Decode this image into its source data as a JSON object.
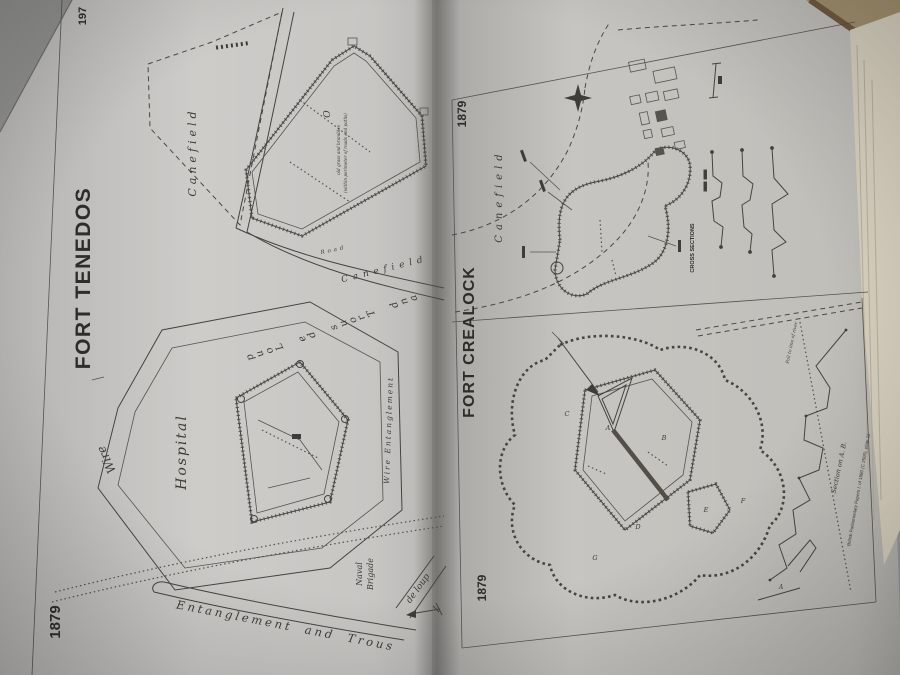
{
  "book": {
    "left_plate": {
      "edge_number": "197",
      "year": "1879",
      "title": "FORT TENEDOS",
      "labels": {
        "canefield": "Canefield",
        "road": "Road",
        "note_line1": "old grass and brambles",
        "note_line2": "(within perimeter of roads and paths)",
        "hospital": "Hospital",
        "wire": "Wire",
        "and_trous_de_loup": "and Trous de Loup",
        "wire_entanglement": "Wire  Entanglement",
        "entanglement_and_trous": "Entanglement  and  Trous",
        "de_loup": "de loup",
        "naval": "Naval",
        "brigade": "Brigade"
      }
    },
    "right_plate": {
      "title": "FORT CREALOCK",
      "year_top": "1879",
      "year_bottom": "1879",
      "labels": {
        "canefield": "Canefield",
        "cross_sections": "CROSS SECTIONS",
        "section_on_ab": "Section on A. B.",
        "fall_note": "Fall to line of river",
        "caption": "British Parliamentary Papers I. of 1880 (C 2505), plate 11"
      },
      "fort_letters": [
        "A",
        "B",
        "C",
        "D",
        "E",
        "F",
        "G"
      ]
    }
  }
}
